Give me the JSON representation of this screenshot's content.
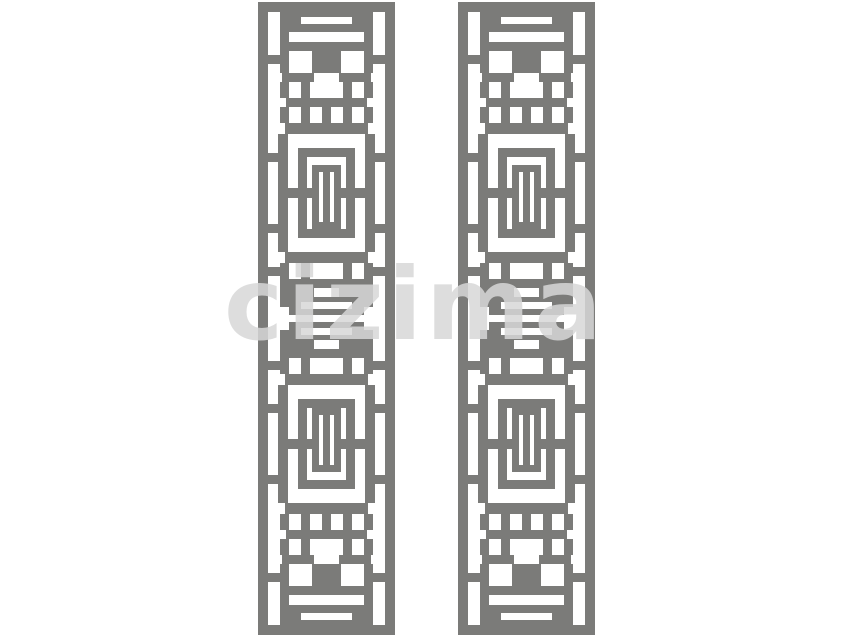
{
  "artwork": {
    "description": "Two identical vertical decorative lattice screen panels (geometric fretwork pattern)",
    "background_color": "#ffffff",
    "lattice_color": "#7b7b79",
    "panel_hole_color": "#ffffff",
    "panels": [
      {
        "name": "left-panel",
        "x": 258,
        "y": 2,
        "width": 137,
        "height": 633
      },
      {
        "name": "right-panel",
        "x": 458,
        "y": 2,
        "width": 137,
        "height": 633
      }
    ],
    "watermark": {
      "text": "cizima",
      "color": "rgba(215,215,215,0.85)"
    }
  },
  "pattern": {
    "viewbox_width": 137,
    "viewbox_height": 633,
    "frame_rects": [
      [
        0,
        0,
        137,
        10
      ],
      [
        0,
        623,
        137,
        10
      ],
      [
        0,
        0,
        10,
        633
      ],
      [
        127,
        0,
        10,
        633
      ]
    ],
    "half_rects": [
      [
        31,
        10,
        75,
        20
      ],
      [
        22,
        10,
        9,
        42
      ],
      [
        106,
        10,
        9,
        42
      ],
      [
        28,
        40,
        81,
        9
      ],
      [
        54,
        49,
        29,
        22
      ],
      [
        22,
        49,
        9,
        22
      ],
      [
        106,
        49,
        9,
        22
      ],
      [
        10,
        53,
        12,
        9
      ],
      [
        115,
        53,
        12,
        9
      ],
      [
        24,
        71,
        32,
        9
      ],
      [
        81,
        71,
        32,
        9
      ],
      [
        43,
        80,
        9,
        16
      ],
      [
        85,
        80,
        9,
        16
      ],
      [
        22,
        80,
        9,
        16
      ],
      [
        106,
        80,
        9,
        16
      ],
      [
        28,
        96,
        81,
        9
      ],
      [
        22,
        105,
        9,
        16
      ],
      [
        106,
        105,
        9,
        16
      ],
      [
        43,
        105,
        9,
        16
      ],
      [
        85,
        105,
        9,
        16
      ],
      [
        64,
        105,
        9,
        16
      ],
      [
        27,
        121,
        83,
        11
      ],
      [
        20,
        132,
        10,
        118
      ],
      [
        107,
        132,
        10,
        118
      ],
      [
        10,
        151,
        10,
        9
      ],
      [
        117,
        151,
        10,
        9
      ],
      [
        10,
        222,
        10,
        9
      ],
      [
        117,
        222,
        10,
        9
      ],
      [
        30,
        186,
        10,
        10
      ],
      [
        97,
        186,
        10,
        10
      ],
      [
        49,
        186,
        5,
        10
      ],
      [
        83,
        186,
        5,
        10
      ],
      [
        40,
        146,
        57,
        9
      ],
      [
        40,
        227,
        57,
        9
      ],
      [
        40,
        146,
        9,
        90
      ],
      [
        88,
        146,
        9,
        90
      ],
      [
        54,
        163,
        29,
        7
      ],
      [
        54,
        220,
        29,
        7
      ],
      [
        54,
        163,
        7,
        64
      ],
      [
        76,
        163,
        7,
        64
      ],
      [
        65,
        170,
        7,
        50
      ],
      [
        27,
        250,
        83,
        11
      ],
      [
        22,
        261,
        9,
        44
      ],
      [
        106,
        261,
        9,
        44
      ],
      [
        43,
        261,
        9,
        16
      ],
      [
        85,
        261,
        9,
        16
      ],
      [
        10,
        265,
        12,
        9
      ],
      [
        115,
        265,
        12,
        9
      ],
      [
        28,
        277,
        81,
        9
      ],
      [
        24,
        286,
        32,
        9
      ],
      [
        81,
        286,
        32,
        9
      ],
      [
        31,
        295,
        75,
        18
      ]
    ],
    "half_slots": [
      [
        43,
        15,
        51,
        7
      ],
      [
        43,
        300,
        51,
        7
      ]
    ]
  }
}
